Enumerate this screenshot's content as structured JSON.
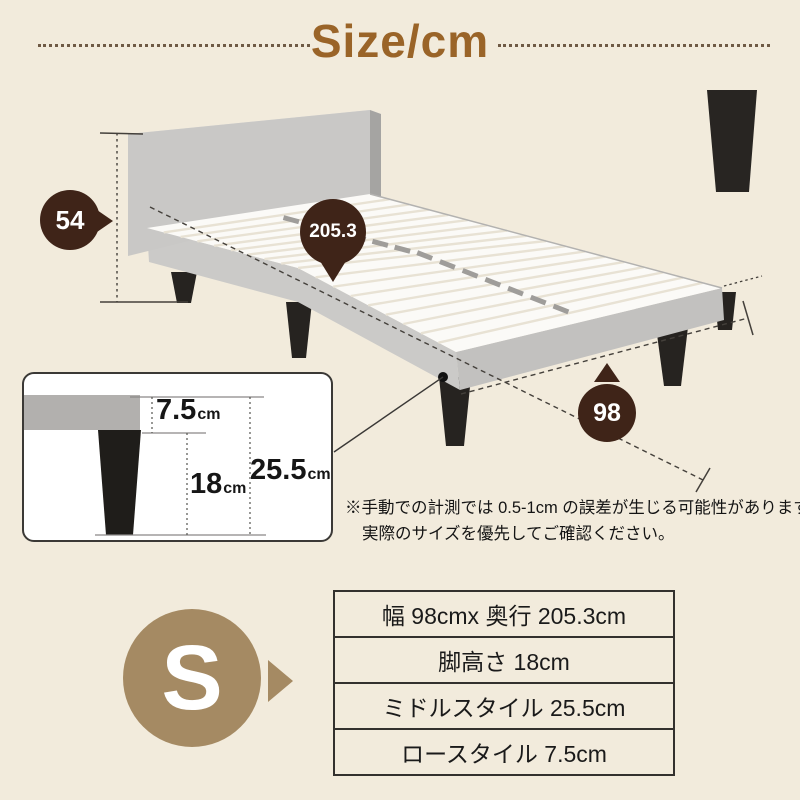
{
  "title": "Size/cm",
  "badges": {
    "height": "54",
    "length": "205.3",
    "width": "98",
    "size": "S"
  },
  "inset": {
    "low_value": "7.5",
    "low_unit": "cm",
    "leg_value": "18",
    "leg_unit": "cm",
    "total_value": "25.5",
    "total_unit": "cm"
  },
  "note": {
    "line1": "※手動での計測では 0.5-1cm の誤差が生じる可能性があります。",
    "line2": "実際のサイズを優先してご確認ください。"
  },
  "spec_table": {
    "rows": [
      {
        "label": "幅 98cmx 奥行 205.3cm"
      },
      {
        "label": "脚高さ 18cm"
      },
      {
        "label": "ミドルスタイル 25.5cm"
      },
      {
        "label": "ロースタイル 7.5cm"
      }
    ]
  },
  "colors": {
    "background": "#f2ebdc",
    "title_brown": "#9a6428",
    "badge_dark_brown": "#3f2418",
    "badge_tan": "#a58a63",
    "frame_gray": "#c9c8c6",
    "slat_white": "#fbfaf7",
    "leg_black": "#262320"
  }
}
